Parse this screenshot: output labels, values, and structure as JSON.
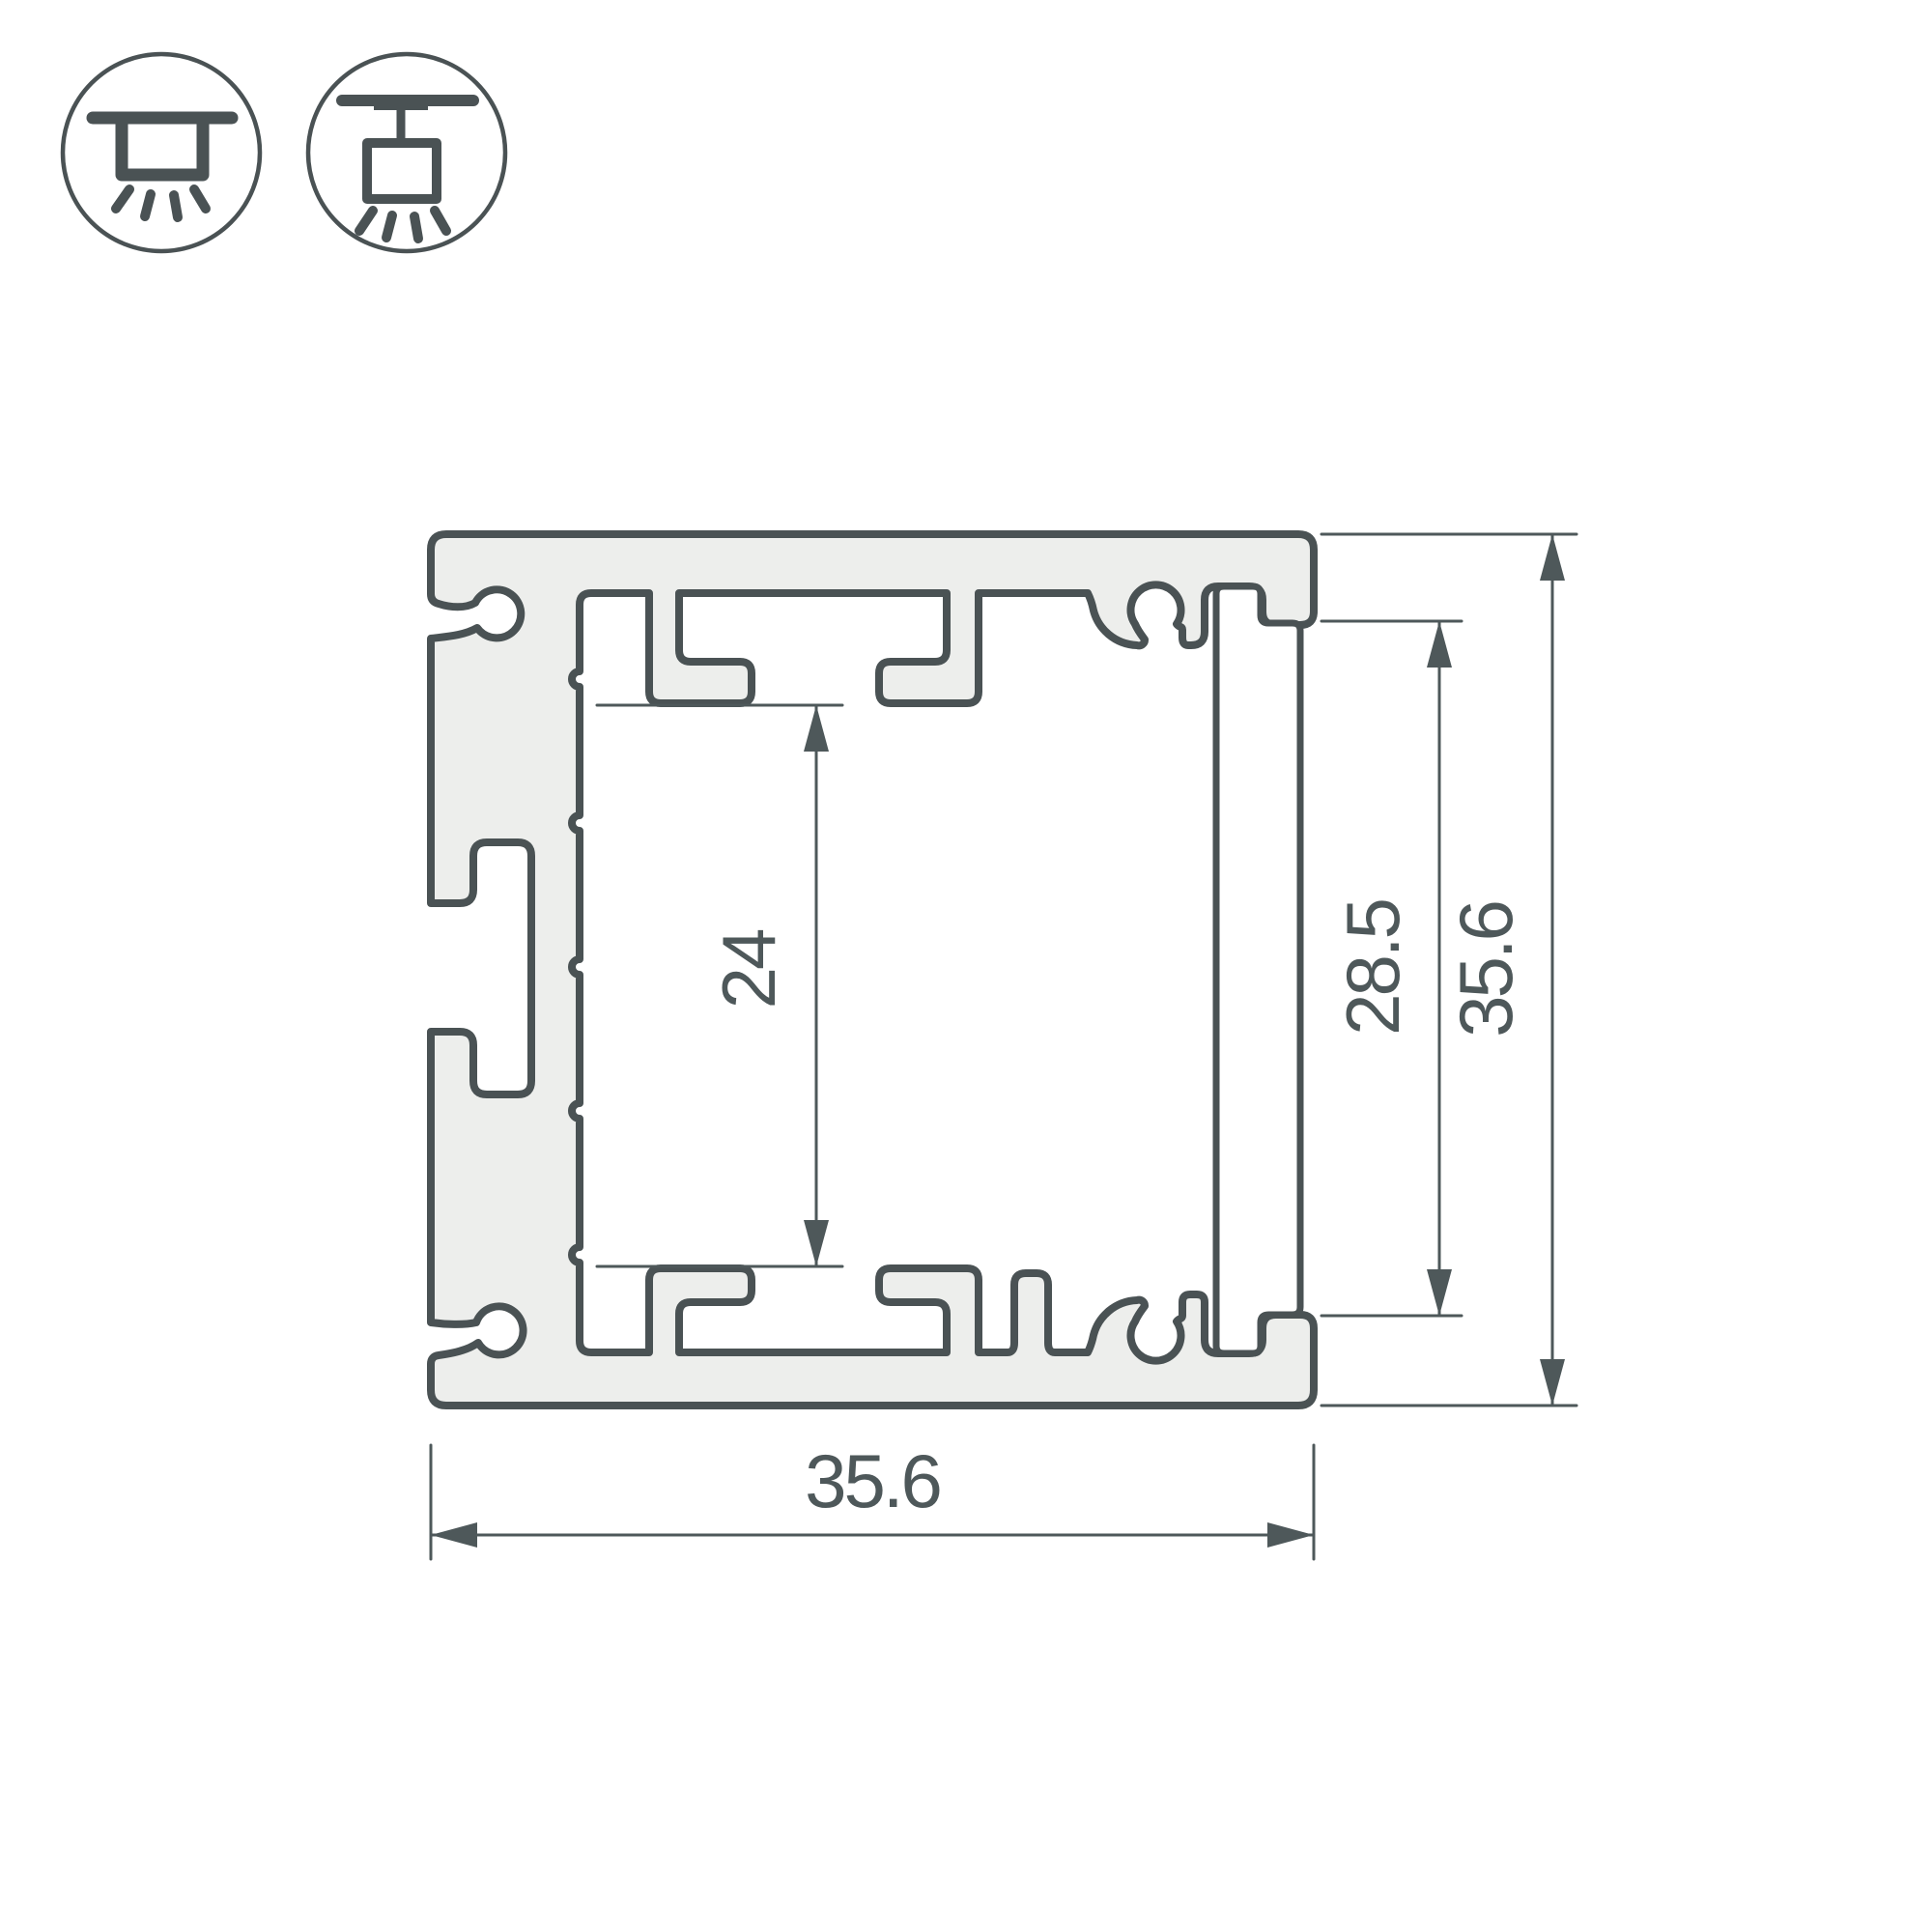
{
  "drawing": {
    "title": "aluminium-profile-cross-section",
    "dimensions": {
      "inner_height": "24",
      "opening_height": "28.5",
      "overall_height": "35.6",
      "overall_width": "35.6"
    },
    "icons": [
      {
        "name": "surface-mount-light-icon"
      },
      {
        "name": "pendant-mount-light-icon"
      }
    ],
    "colors": {
      "outline": "#4a5254",
      "body_fill": "#edeeec",
      "hatch": "#4d5759",
      "dimension": "#4e585a",
      "background": "#ffffff"
    }
  }
}
